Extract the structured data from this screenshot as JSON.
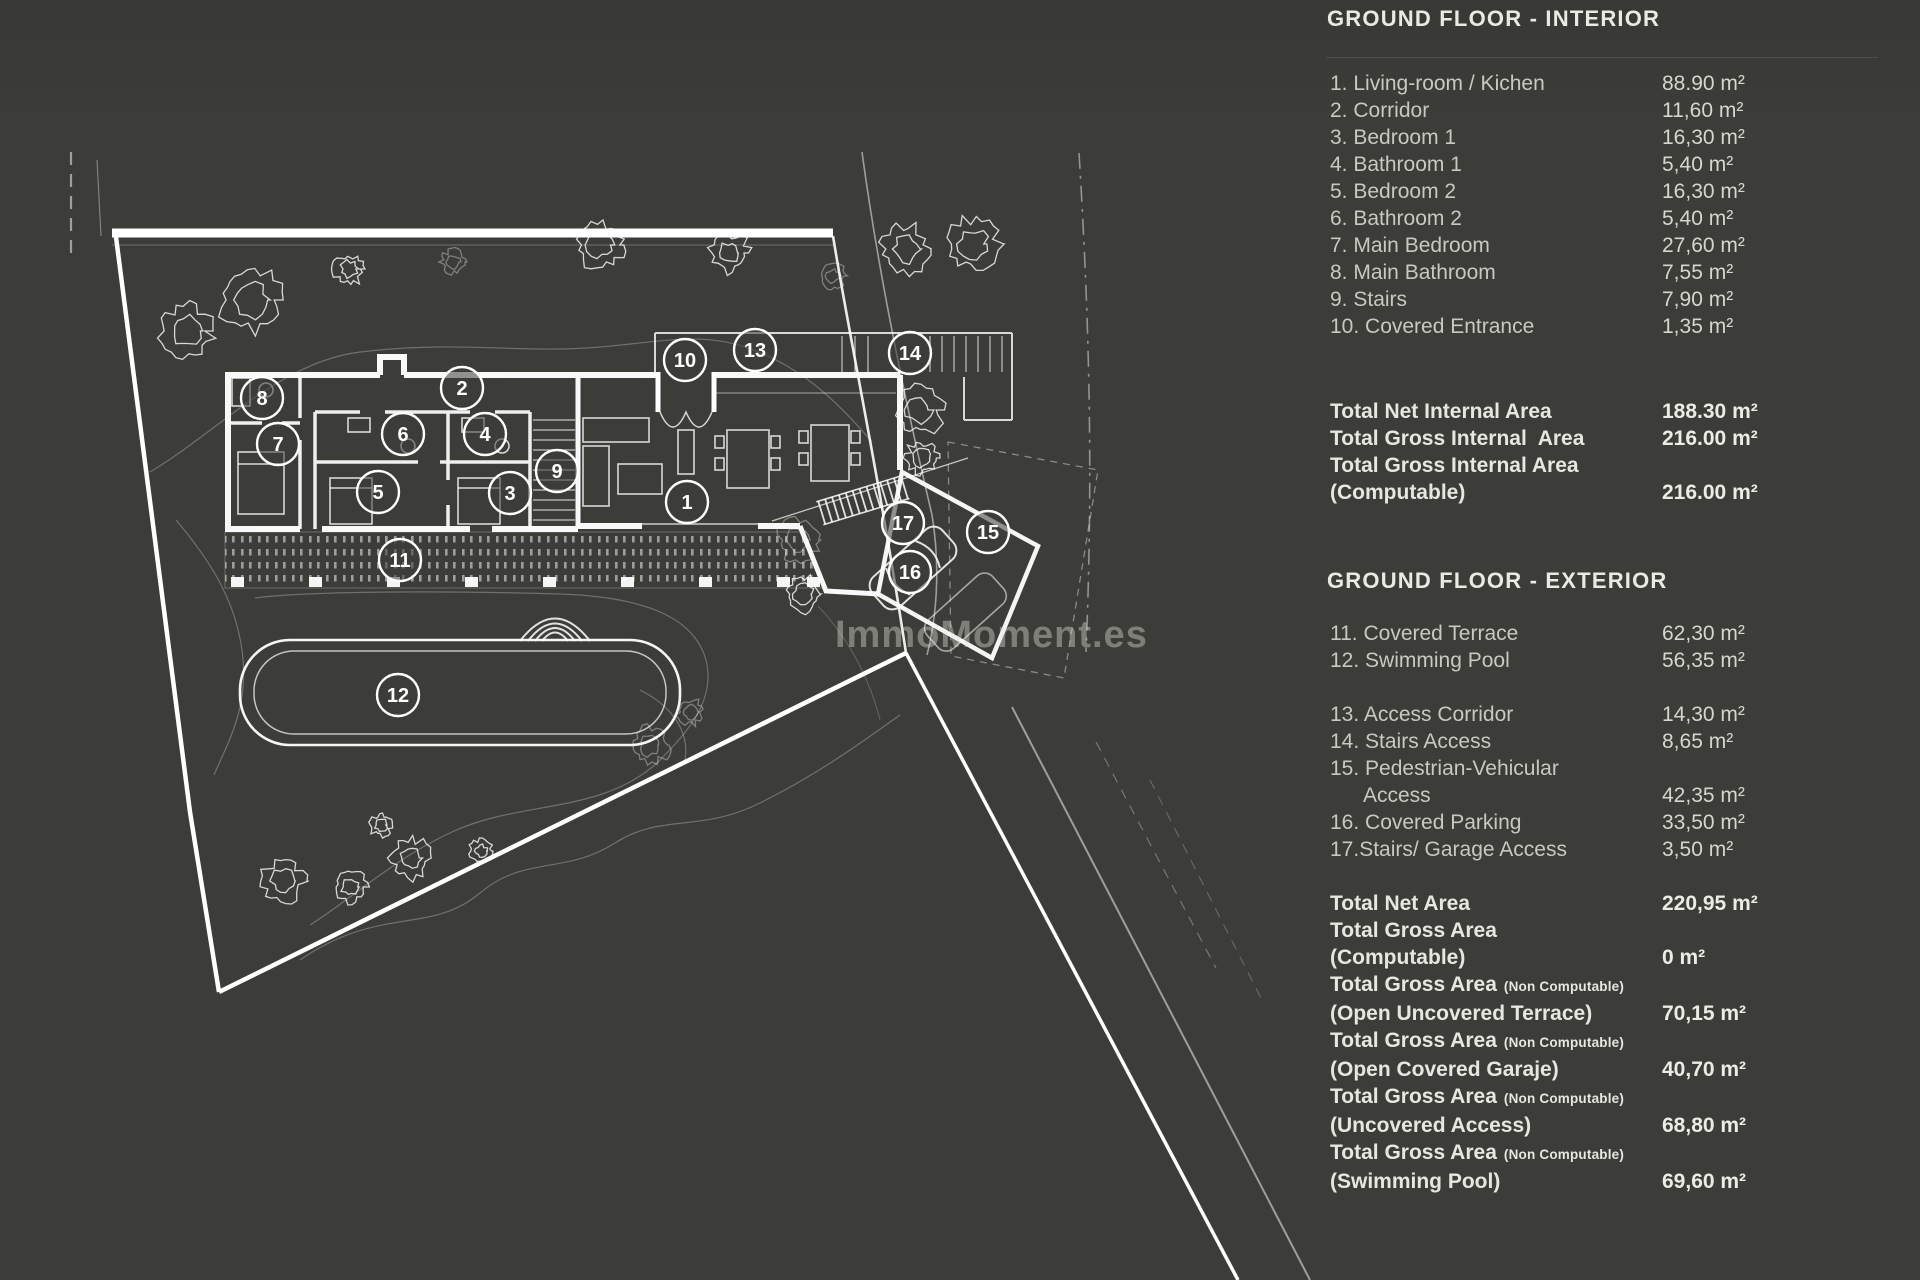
{
  "watermark": {
    "text": "ImmoMoment.es"
  },
  "interior": {
    "title": "GROUND FLOOR - INTERIOR",
    "items": [
      {
        "label": "1. Living-room / Kichen",
        "value": "88.90 m²"
      },
      {
        "label": "2. Corridor",
        "value": "11,60 m²"
      },
      {
        "label": "3. Bedroom 1",
        "value": "16,30 m²"
      },
      {
        "label": "4. Bathroom 1",
        "value": "5,40 m²"
      },
      {
        "label": "5. Bedroom 2",
        "value": "16,30 m²"
      },
      {
        "label": "6. Bathroom 2",
        "value": "5,40 m²"
      },
      {
        "label": "7. Main Bedroom",
        "value": "27,60 m²"
      },
      {
        "label": "8. Main Bathroom",
        "value": "7,55 m²"
      },
      {
        "label": "9. Stairs",
        "value": "7,90 m²"
      },
      {
        "label": "10. Covered Entrance",
        "value": "1,35 m²"
      }
    ],
    "totals": [
      {
        "label": "Total Net Internal Area",
        "value": "188.30 m²"
      },
      {
        "label": "Total Gross Internal  Area",
        "value": "216.00 m²"
      },
      {
        "label": "Total Gross Internal Area",
        "value": ""
      },
      {
        "label": "(Computable)",
        "value": "216.00 m²"
      }
    ]
  },
  "exterior": {
    "title": "GROUND FLOOR - EXTERIOR",
    "items": [
      {
        "label": "11. Covered Terrace",
        "value": "62,30 m²"
      },
      {
        "label": "12. Swimming Pool",
        "value": "56,35 m²"
      },
      {
        "label": "",
        "value": ""
      },
      {
        "label": "13. Access Corridor",
        "value": "14,30 m²"
      },
      {
        "label": "14. Stairs Access",
        "value": "8,65 m²"
      },
      {
        "label": "15. Pedestrian-Vehicular",
        "value": ""
      },
      {
        "label": "Access",
        "indent": true,
        "value": "42,35 m²"
      },
      {
        "label": "16. Covered Parking",
        "value": "33,50 m²"
      },
      {
        "label": "17.Stairs/ Garage Access",
        "value": "3,50 m²"
      }
    ],
    "totals": [
      {
        "label": "Total Net Area",
        "value": "220,95 m²"
      },
      {
        "label": "Total Gross Area",
        "value": ""
      },
      {
        "label": "(Computable)",
        "value": "0 m²"
      },
      {
        "label": "Total Gross Area",
        "suffix": "(Non Computable)",
        "value": ""
      },
      {
        "label": "(Open Uncovered Terrace)",
        "value": "70,15 m²"
      },
      {
        "label": "Total Gross Area",
        "suffix": "(Non Computable)",
        "value": ""
      },
      {
        "label": "(Open Covered Garaje)",
        "value": "40,70 m²"
      },
      {
        "label": "Total Gross Area",
        "suffix": "(Non Computable)",
        "value": ""
      },
      {
        "label": "(Uncovered Access)",
        "value": "68,80 m²"
      },
      {
        "label": "Total Gross Area",
        "suffix": "(Non Computable)",
        "value": ""
      },
      {
        "label": "(Swimming Pool)",
        "value": "69,60 m²"
      }
    ]
  },
  "plan": {
    "markers": [
      {
        "n": "1",
        "x": 687,
        "y": 502
      },
      {
        "n": "2",
        "x": 462,
        "y": 388
      },
      {
        "n": "3",
        "x": 510,
        "y": 493
      },
      {
        "n": "4",
        "x": 485,
        "y": 434
      },
      {
        "n": "5",
        "x": 378,
        "y": 492
      },
      {
        "n": "6",
        "x": 403,
        "y": 434
      },
      {
        "n": "7",
        "x": 278,
        "y": 444
      },
      {
        "n": "8",
        "x": 262,
        "y": 398
      },
      {
        "n": "9",
        "x": 557,
        "y": 471
      },
      {
        "n": "10",
        "x": 685,
        "y": 360
      },
      {
        "n": "11",
        "x": 400,
        "y": 560
      },
      {
        "n": "12",
        "x": 398,
        "y": 695
      },
      {
        "n": "13",
        "x": 755,
        "y": 350
      },
      {
        "n": "14",
        "x": 910,
        "y": 353
      },
      {
        "n": "15",
        "x": 988,
        "y": 532
      },
      {
        "n": "16",
        "x": 910,
        "y": 572
      },
      {
        "n": "17",
        "x": 903,
        "y": 523
      }
    ]
  }
}
